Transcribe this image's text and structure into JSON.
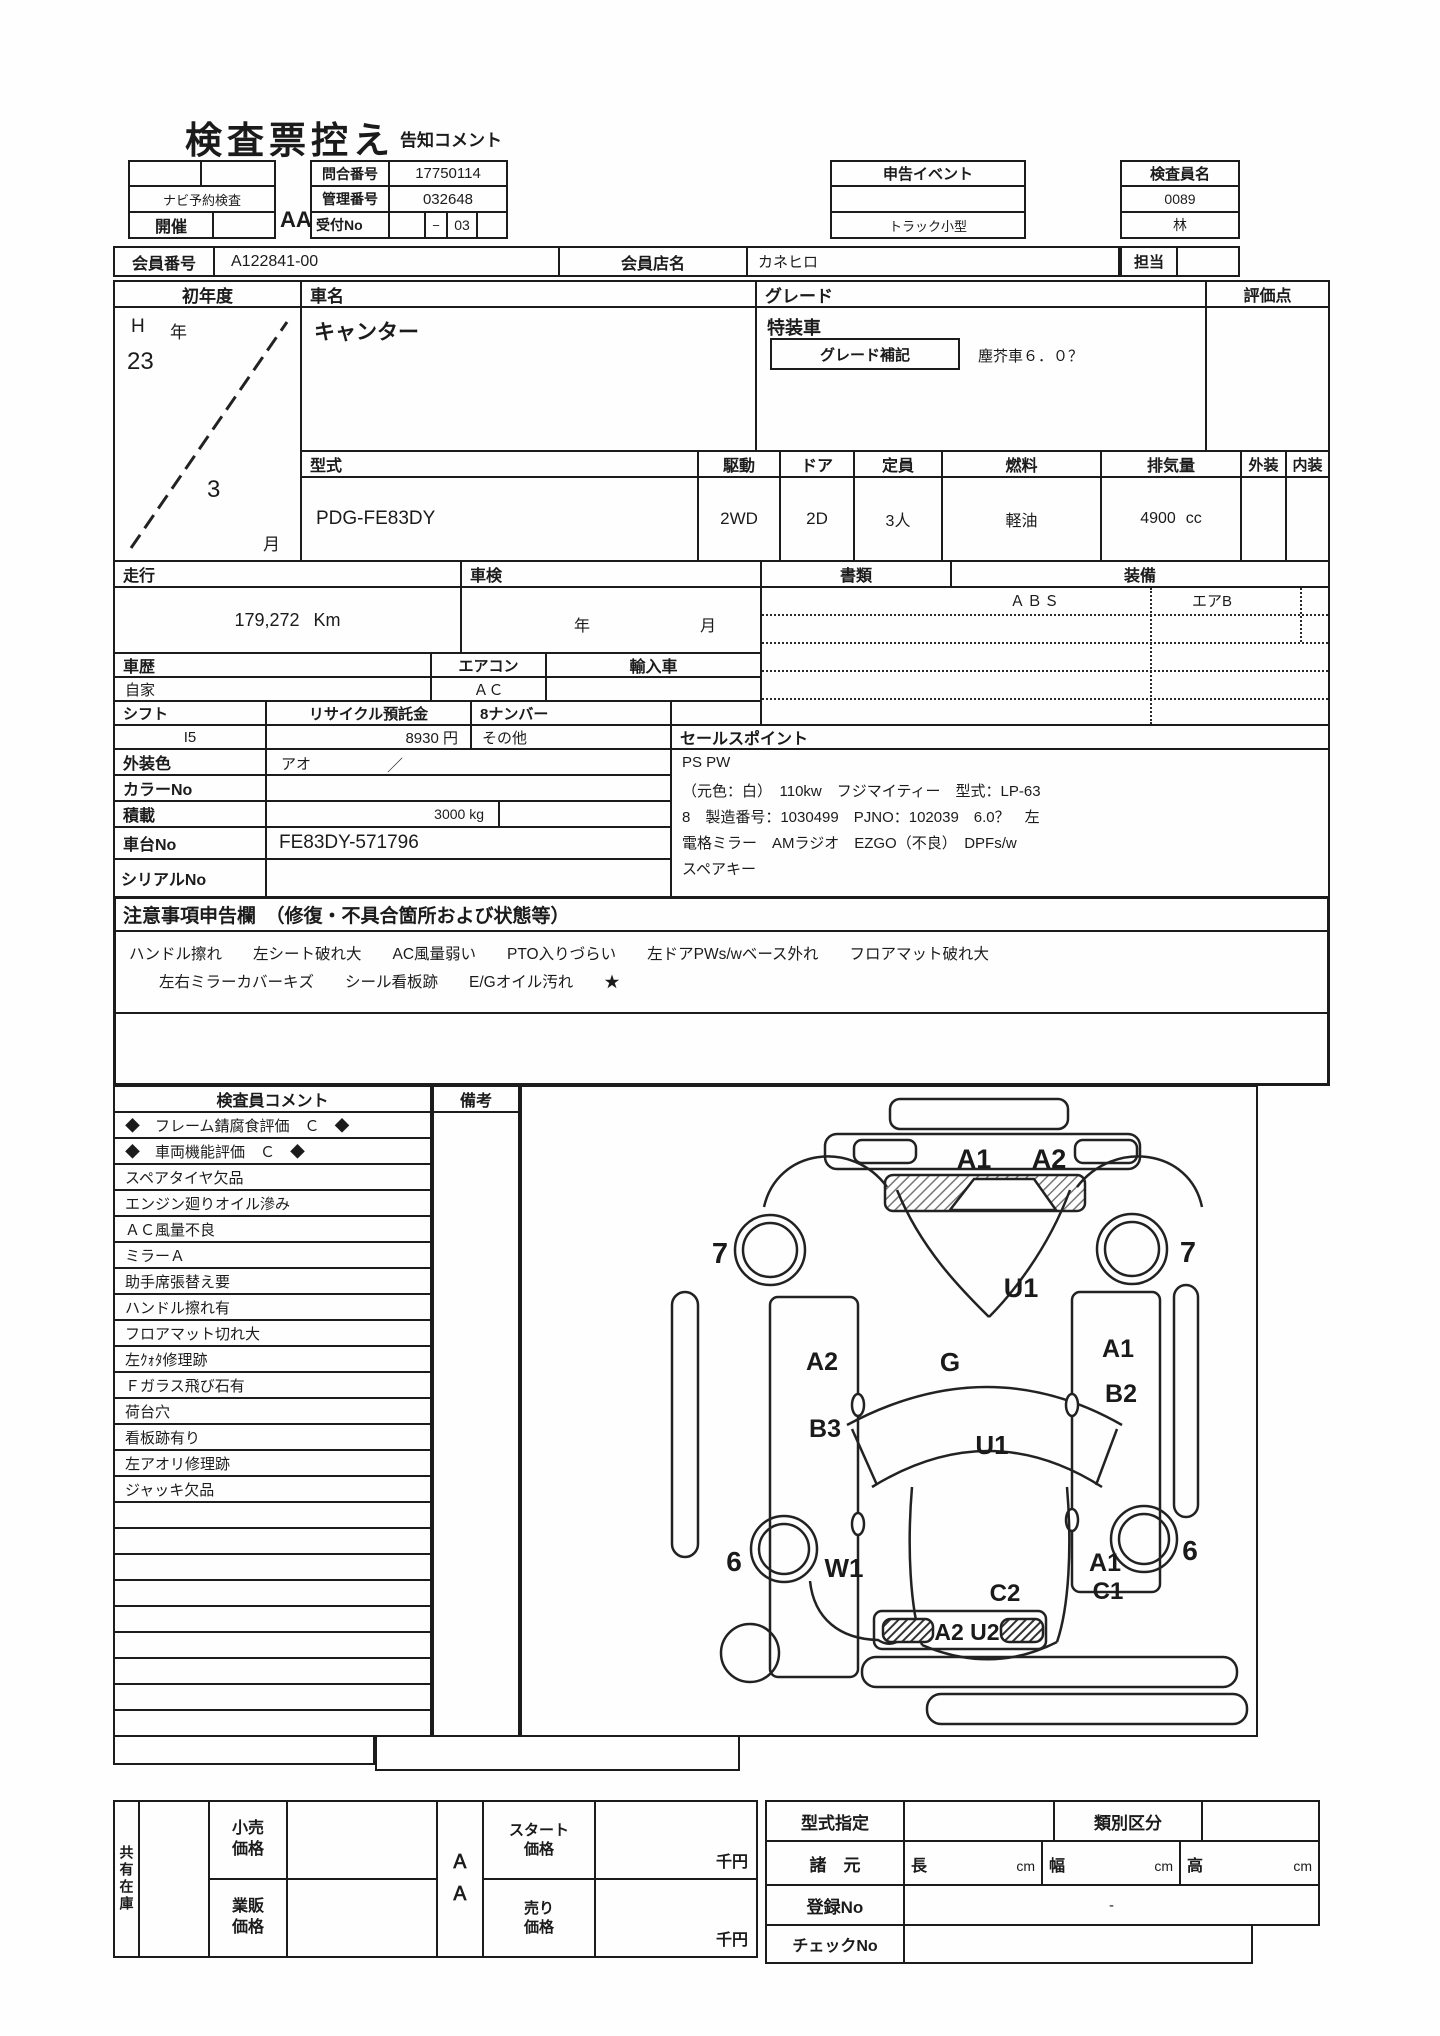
{
  "title": "検査票控え",
  "subtitle": "告知コメント",
  "top": {
    "reserve": "ナビ予約検査",
    "kaisai": "開催",
    "aa": "AA",
    "inquiry_label": "問合番号",
    "inquiry_no": "17750114",
    "control_label": "管理番号",
    "control_no": "032648",
    "reception_label": "受付No",
    "reception_dash": "−",
    "reception_no": "03",
    "event_label": "申告イベント",
    "event_value": "トラック小型",
    "inspector_label": "検査員名",
    "inspector_no": "0089",
    "inspector_name": "林",
    "tanto": "担当"
  },
  "member": {
    "no_label": "会員番号",
    "no": "A122841-00",
    "shop_label": "会員店名",
    "shop": "カネヒロ"
  },
  "vehicle": {
    "first_year_label": "初年度",
    "era": "H",
    "era_suffix": "年",
    "year": "23",
    "month": "3",
    "month_suffix": "月",
    "name_label": "車名",
    "name": "キャンター",
    "grade_label": "グレード",
    "special_label": "特装車",
    "grade_note_label": "グレード補記",
    "grade_note": "塵芥車６．０？",
    "score_label": "評価点",
    "model_label": "型式",
    "model": "PDG-FE83DY",
    "drive_label": "駆動",
    "drive": "2WD",
    "door_label": "ドア",
    "door": "2D",
    "capacity_label": "定員",
    "capacity": "3人",
    "fuel_label": "燃料",
    "fuel": "軽油",
    "displacement_label": "排気量",
    "displacement": "4900",
    "displacement_unit": "cc",
    "exterior_label": "外装",
    "interior_label": "内装"
  },
  "condition": {
    "mileage_label": "走行",
    "mileage": "179,272",
    "mileage_unit": "Km",
    "shaken_label": "車検",
    "shaken_year": "年",
    "shaken_month": "月",
    "docs_label": "書類",
    "equip_label": "装備",
    "equip1": "ＡＢＳ",
    "equip2": "エアB",
    "history_label": "車歴",
    "history": "自家",
    "aircon_label": "エアコン",
    "aircon": "ＡＣ",
    "import_label": "輸入車",
    "shift_label": "シフト",
    "shift": "I5",
    "recycle_label": "リサイクル預託金",
    "recycle": "8930 円",
    "number8_label": "8ナンバー",
    "number8": "その他",
    "sales_label": "セールスポイント",
    "sales1": "PS PW",
    "sales2": "（元色：白）　110kw　フジマイティー　型式：LP-63",
    "sales3": "8　製造番号：1030499　PJNO：102039　6.0？　左",
    "sales4": "電格ミラー　AMラジオ　EZGO（不良）　DPFs/w",
    "sales5": "スペアキー",
    "color_label": "外装色",
    "color": "アオ",
    "color_slash": "／",
    "colorno_label": "カラーNo",
    "payload_label": "積載",
    "payload": "3000 kg",
    "chassis_label": "車台No",
    "chassis": "FE83DY-571796",
    "serial_label": "シリアルNo"
  },
  "notice": {
    "header": "注意事項申告欄　（修復・不具合箇所および状態等）",
    "line1": "ハンドル擦れ　　左シート破れ大　　AC風量弱い　　PTO入りづらい　　左ドアPWs/wベース外れ　　フロアマット破れ大",
    "line2": "左右ミラーカバーキズ　　シール看板跡　　E/Gオイル汚れ　　★"
  },
  "inspection": {
    "comment_header": "検査員コメント",
    "remarks_header": "備考",
    "comments": [
      "◆　フレーム錆腐食評価　Ｃ　◆",
      "◆　車両機能評価　Ｃ　◆",
      "スペアタイヤ欠品",
      "エンジン廻りオイル滲み",
      "ＡＣ風量不良",
      "ミラーＡ",
      "助手席張替え要",
      "ハンドル擦れ有",
      "フロアマット切れ大",
      "左ｸｫﾀ修理跡",
      "Ｆガラス飛び石有",
      "荷台穴",
      "看板跡有り",
      "左アオリ修理跡",
      "ジャッキ欠品",
      "",
      "",
      "",
      "",
      "",
      "",
      "",
      "",
      ""
    ]
  },
  "diagram": {
    "a1_top": "A1",
    "a2_top": "A2",
    "seven_left": "7",
    "seven_right": "7",
    "u1_upper": "U1",
    "g": "G",
    "a2_left": "A2",
    "b3_left": "B3",
    "a1_right": "A1",
    "b2_right": "B2",
    "u1_mid": "U1",
    "six_left": "6",
    "six_right": "6",
    "w1": "W1",
    "a1_rear": "A1",
    "c2": "C2",
    "c1": "C1",
    "a2u2": "A2 U2"
  },
  "pricing": {
    "stock": "共有在庫",
    "retail_label": "小売価格",
    "wholesale_label": "業販価格",
    "aa": "ＡＡ",
    "start_label": "スタート価格",
    "sell_label": "売り価格",
    "unit": "千円",
    "model_spec_label": "型式指定",
    "class_label": "類別区分",
    "dimensions_label": "諸　元",
    "length_label": "長",
    "width_label": "幅",
    "height_label": "高",
    "cm": "cm",
    "reg_label": "登録No",
    "reg_value": "-",
    "check_label": "チェックNo"
  }
}
